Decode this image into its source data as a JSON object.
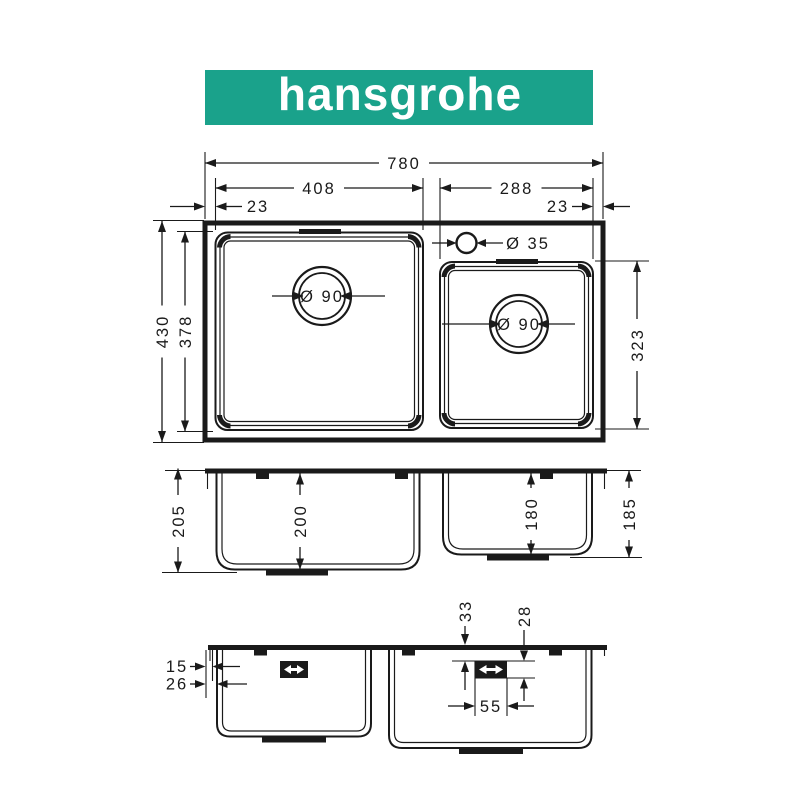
{
  "brand": {
    "name": "hansgrohe"
  },
  "colors": {
    "brand_green": "#1aa28b",
    "line": "#1a1a1a",
    "background": "#ffffff"
  },
  "views": {
    "top": {
      "overall_width": "780",
      "left_bowl_width": "408",
      "right_bowl_width": "288",
      "left_rim_offset": "23",
      "right_rim_offset": "23",
      "overall_depth": "430",
      "left_bowl_depth": "378",
      "right_bowl_depth": "323",
      "tap_hole_diameter": "Ø 35",
      "left_drain_diameter": "Ø 90",
      "right_drain_diameter": "Ø 90"
    },
    "front": {
      "left_outer_height": "205",
      "left_bowl_height": "200",
      "right_bowl_height": "180",
      "right_outer_height": "185"
    },
    "bottom": {
      "rim_lip": "15",
      "rim_to_wall": "26",
      "clip_top_offset": "33",
      "clip_height": "28",
      "clip_width": "55"
    }
  }
}
